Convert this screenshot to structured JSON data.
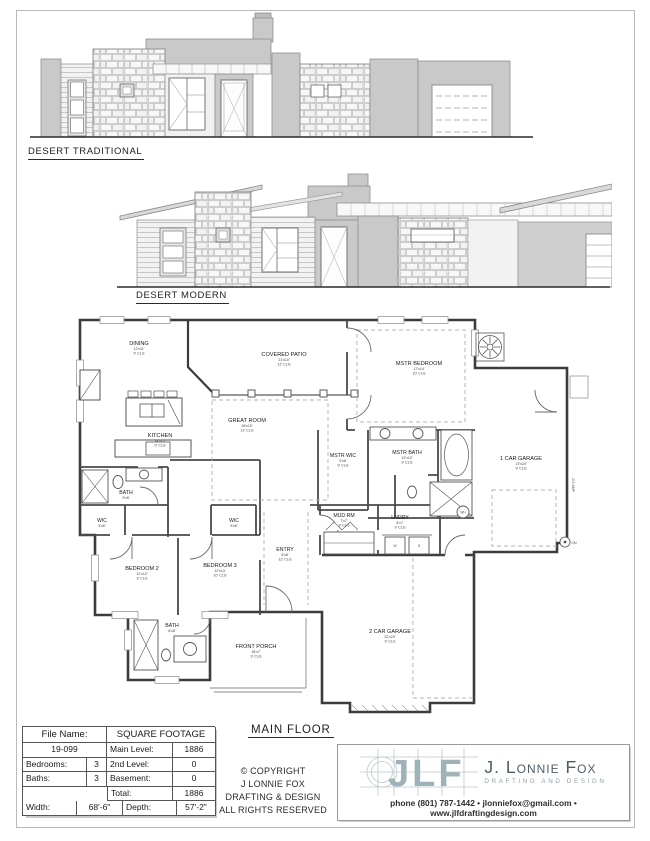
{
  "elevations": {
    "traditional_label": "DESERT TRADITIONAL",
    "modern_label": "DESERT MODERN"
  },
  "plan": {
    "title": "MAIN FLOOR",
    "rooms": [
      {
        "name": "DINING",
        "size": "12'x11'",
        "clg": "9' CLG"
      },
      {
        "name": "COVERED PATIO",
        "size": "21'x10'",
        "clg": "12' CLG"
      },
      {
        "name": "MSTR BEDROOM",
        "size": "17'x14'",
        "clg": "10' CLG"
      },
      {
        "name": "GREAT ROOM",
        "size": "18'x19'",
        "clg": "12' CLG"
      },
      {
        "name": "KITCHEN",
        "size": "14'x12'",
        "clg": "9' CLG"
      },
      {
        "name": "MSTR WIC",
        "size": "9'x8'",
        "clg": "9' CLG"
      },
      {
        "name": "MSTR BATH",
        "size": "12'x10'",
        "clg": "9' CLG"
      },
      {
        "name": "1 CAR GARAGE",
        "size": "13'x24'",
        "clg": "9' CLG"
      },
      {
        "name": "BATH",
        "size": "9'x5'"
      },
      {
        "name": "WIC",
        "size": "5'x6'"
      },
      {
        "name": "WIC",
        "size": "5'x6'"
      },
      {
        "name": "MUD RM",
        "size": "7'x7'",
        "clg": "9' CLG"
      },
      {
        "name": "LNDRY",
        "size": "8'x7'",
        "clg": "9' CLG"
      },
      {
        "name": "ENTRY",
        "size": "8'x8'",
        "clg": "12' CLG"
      },
      {
        "name": "BEDROOM 2",
        "size": "12'x12'",
        "clg": "9' CLG"
      },
      {
        "name": "BEDROOM 3",
        "size": "12'x13'",
        "clg": "10' CLG"
      },
      {
        "name": "BATH",
        "size": "8'x8'"
      },
      {
        "name": "FRONT PORCH",
        "size": "16'x7'",
        "clg": "9' CLG"
      },
      {
        "name": "2 CAR GARAGE",
        "size": "22'x23'",
        "clg": "9' CLG"
      }
    ],
    "annotations": {
      "panel": "200 AMP",
      "gas_meter": "GM",
      "water_heater": "WH",
      "washer": "W",
      "dryer": "D"
    }
  },
  "info_table": {
    "file_name_label": "File Name:",
    "file_name_value": "19-099",
    "sqft_header": "SQUARE FOOTAGE",
    "main_level_label": "Main Level:",
    "main_level_value": "1886",
    "bedrooms_label": "Bedrooms:",
    "bedrooms_value": "3",
    "second_level_label": "2nd Level:",
    "second_level_value": "0",
    "baths_label": "Baths:",
    "baths_value": "3",
    "basement_label": "Basement:",
    "basement_value": "0",
    "total_label": "Total:",
    "total_value": "1886",
    "width_label": "Width:",
    "width_value": "68'-6\"",
    "depth_label": "Depth:",
    "depth_value": "57'-2\""
  },
  "copyright": {
    "lines": [
      "© COPYRIGHT",
      "J LONNIE FOX",
      "DRAFTING & DESIGN",
      "ALL RIGHTS RESERVED"
    ]
  },
  "logo": {
    "monogram": "JLF",
    "name": "J. Lonnie Fox",
    "tagline": "DRAFTING AND DESIGN",
    "contact": "phone (801) 787-1442 • jlonniefox@gmail.com • www.jlfdraftingdesign.com",
    "accent_color": "#9fb1b9",
    "dark_color": "#4d5e68"
  }
}
